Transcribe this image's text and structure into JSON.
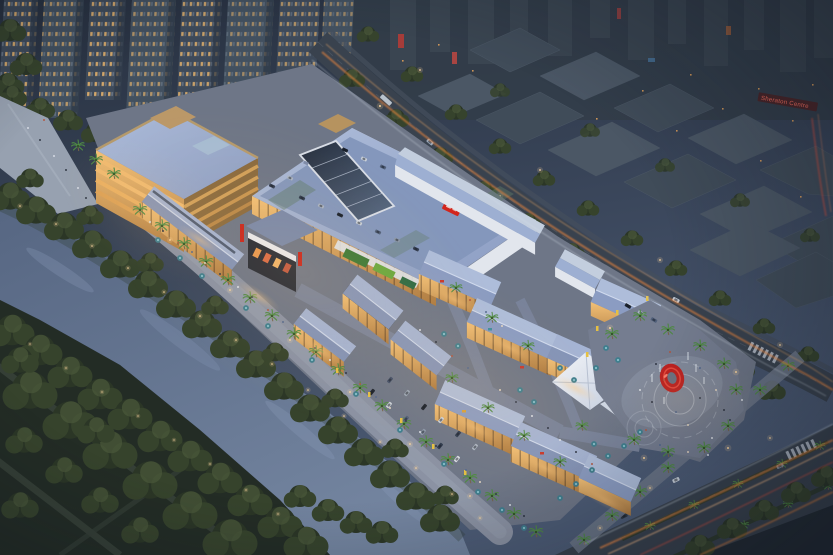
{
  "scene": {
    "type": "aerial architectural rendering",
    "time_of_day": "dusk",
    "subject": "riverside open-air shopping mall complex with illuminated retail streets, rooftop parking deck, entrance plaza with red ring sculpture, winding river and city backdrop",
    "regions": [
      "residential towers",
      "city massing blocks",
      "main road",
      "river",
      "riverside park",
      "waterfront promenade",
      "office block",
      "anchor mall with rooftop parking",
      "central skylight",
      "cinema facade",
      "retail village",
      "white canopy tent",
      "entrance plaza",
      "red ring sculpture",
      "boulevard with light trails"
    ]
  },
  "signs": {
    "sheraton_centre": "Sheraton Centre"
  },
  "palette": {
    "sky-top": "#27303f",
    "sky-low": "#4d5c76",
    "city-block": "#404c59",
    "city-block-light": "#4b5765",
    "tree-dark": "#2b3626",
    "tree-mid": "#36432c",
    "tree-hi": "#49573a",
    "river-hi": "#73849f",
    "river-lo": "#566682",
    "park": "#232c25",
    "road": "#39424e",
    "roof-hi": "#aebdda",
    "roof-lo": "#8b9cc2",
    "white-wall": "#e2e6ed",
    "facade-hi": "#f2c077",
    "facade-lo": "#ad7a40",
    "glow": "#ffc87e",
    "trail-orange": "#ff8c3a",
    "trail-red": "#e0503c",
    "trail-white": "#d5dfe9",
    "sign-red": "#d2251c",
    "sculpture-red": "#bf1f1e",
    "umbrella": "#3f7e8e",
    "palm": "#4f8a44",
    "paving": "#6e7687",
    "promenade": "#8b92a3",
    "window-warm": "#ecb76d",
    "lamp": "#ffd9a0"
  }
}
